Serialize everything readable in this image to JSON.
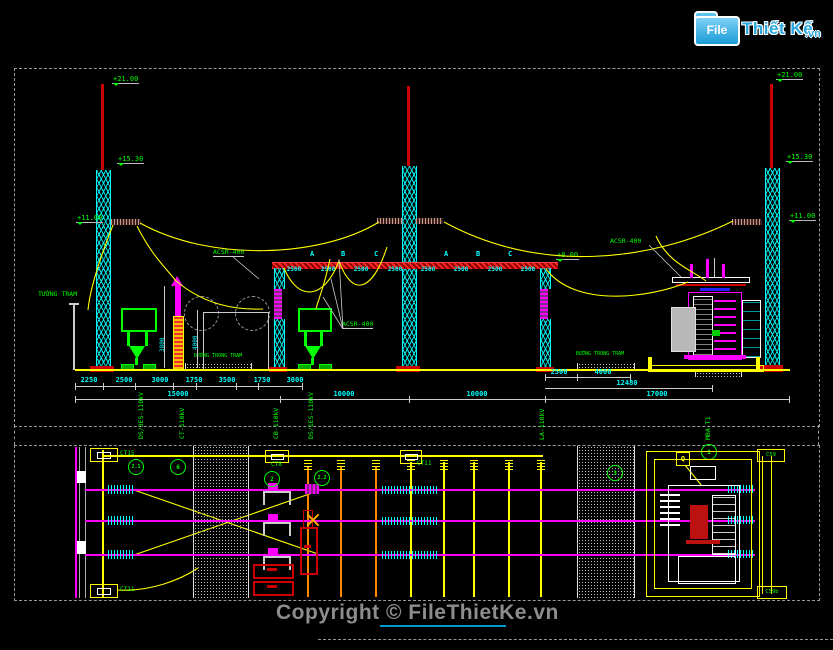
{
  "logo": {
    "file": "File",
    "name": "Thiết Kế",
    "tld": ".vn"
  },
  "copyright": "Copyright © FileThietKe.vn",
  "colors": {
    "green": "#00ff00",
    "cyan": "#00ffff",
    "yellow": "#ffff00",
    "magenta": "#ff00ff",
    "red": "#dd0000",
    "logo_blue": "#29a8e0"
  },
  "elevation": {
    "levels": {
      "left_top": "+21.00",
      "left_mid": "+15.30",
      "left_low": "+11.00",
      "right_top": "+21.00",
      "right_mid": "+15.30",
      "right_low": "+11.00",
      "center": "+8.00"
    },
    "wire_labels": {
      "left": "ACSR-400",
      "mid": "ACSR-400",
      "right": "ACSR-400"
    },
    "station_wall": "TƯỜNG TRẠM",
    "road_label_1": "ĐƯỜNG TRONG TRẠM",
    "road_label_2": "ĐƯỜNG TRONG TRẠM",
    "phase_labels": [
      "A",
      "B",
      "C",
      "A",
      "B",
      "C"
    ],
    "bay_dims": [
      "2500",
      "2500",
      "2500",
      "2500",
      "2500",
      "2500",
      "2500",
      "2500"
    ],
    "ground_dims_left": [
      "2250",
      "2500",
      "3000",
      "1750",
      "3500",
      "1750",
      "3000"
    ],
    "ground_dims_right": [
      "2500",
      "4000"
    ],
    "dim_12480": "12480",
    "total_dims": [
      "15000",
      "10000",
      "10000",
      "17000"
    ],
    "column_dims": [
      "3800",
      "4000"
    ]
  },
  "plan": {
    "bay_headers": [
      "DS/3ES-110kV",
      "CT-110kV",
      "CB-110kV",
      "DS/1ES-110kV",
      "LA-110kV",
      "MBA-T1"
    ],
    "foundation_tags": {
      "top_left": "CT15",
      "bottom_left": "CT11",
      "bus_left": "CT8",
      "bus_right": "CT11",
      "right_top": "C59",
      "right_bottom": "C59b"
    },
    "balloons": [
      "2.1",
      "6",
      "2",
      "2.2",
      "3",
      "1"
    ],
    "q_tag": "Q"
  }
}
